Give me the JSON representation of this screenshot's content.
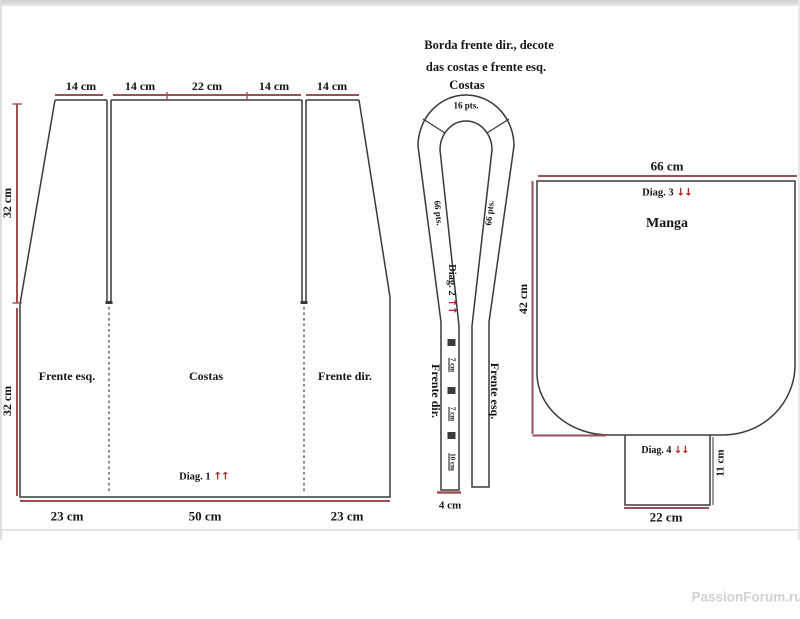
{
  "colors": {
    "line": "#3a3a3a",
    "dimension": "#9b5151",
    "arrow": "#b22222",
    "text": "#161616",
    "watermark": "#d2d2d2"
  },
  "watermark": "PassionForum.ru",
  "body_piece": {
    "top_dims": [
      "14 cm",
      "14 cm",
      "22 cm",
      "14 cm",
      "14 cm"
    ],
    "left_dims": [
      "32 cm",
      "32 cm"
    ],
    "bottom_dims": [
      "23 cm",
      "50 cm",
      "23 cm"
    ],
    "panels": [
      "Frente esq.",
      "Costas",
      "Frente dir."
    ],
    "diag": "Diag. 1",
    "diag_arrows": "↑↑"
  },
  "neckband": {
    "title_line1": "Borda frente dir., decote",
    "title_line2": "das costas e frente esq.",
    "title_line3": "Costas",
    "top_pts": "16 pts.",
    "left_pts": "66 pts.",
    "right_pts": "66 pts.",
    "diag": "Diag. 2",
    "diag_arrows": "↑↑",
    "left_label": "Frente dir.",
    "right_label": "Frente esq.",
    "marks": [
      "7 cm",
      "7 cm",
      "10 cm"
    ],
    "bottom_dim": "4 cm"
  },
  "sleeve": {
    "top_dim": "66 cm",
    "label": "Manga",
    "diag": "Diag. 3",
    "diag_arrows": "↓↓",
    "left_dim": "42 cm",
    "cuff": {
      "diag": "Diag. 4",
      "diag_arrows": "↓↓",
      "right_dim": "11 cm",
      "bottom_dim": "22 cm"
    }
  }
}
